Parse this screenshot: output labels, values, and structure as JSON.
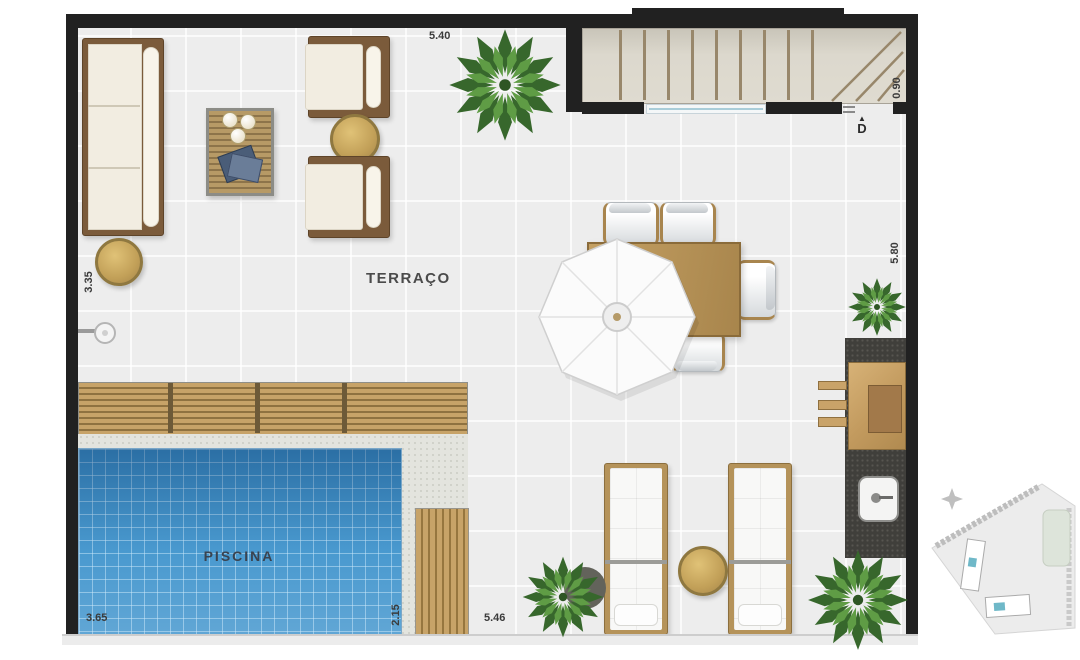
{
  "plan": {
    "room_labels": {
      "terrace": "TERRAÇO",
      "pool": "PISCINA"
    },
    "dimensions": {
      "top": "5.40",
      "stair_depth": "0.90",
      "right_height": "5.80",
      "left_height": "3.35",
      "pool_length": "3.65",
      "pool_width": "2.15",
      "bottom_width": "5.46"
    },
    "door": {
      "label": "D",
      "arrow": "▲"
    },
    "colors": {
      "wall": "#212121",
      "floor": "#ededed",
      "pool_water": "#3e93cc",
      "wood_light": "#c7a368",
      "wood_dark": "#7b5b3b",
      "counter": "#403f3b",
      "plant_green": "#4a8038",
      "gold_table": "#c9a662"
    }
  }
}
